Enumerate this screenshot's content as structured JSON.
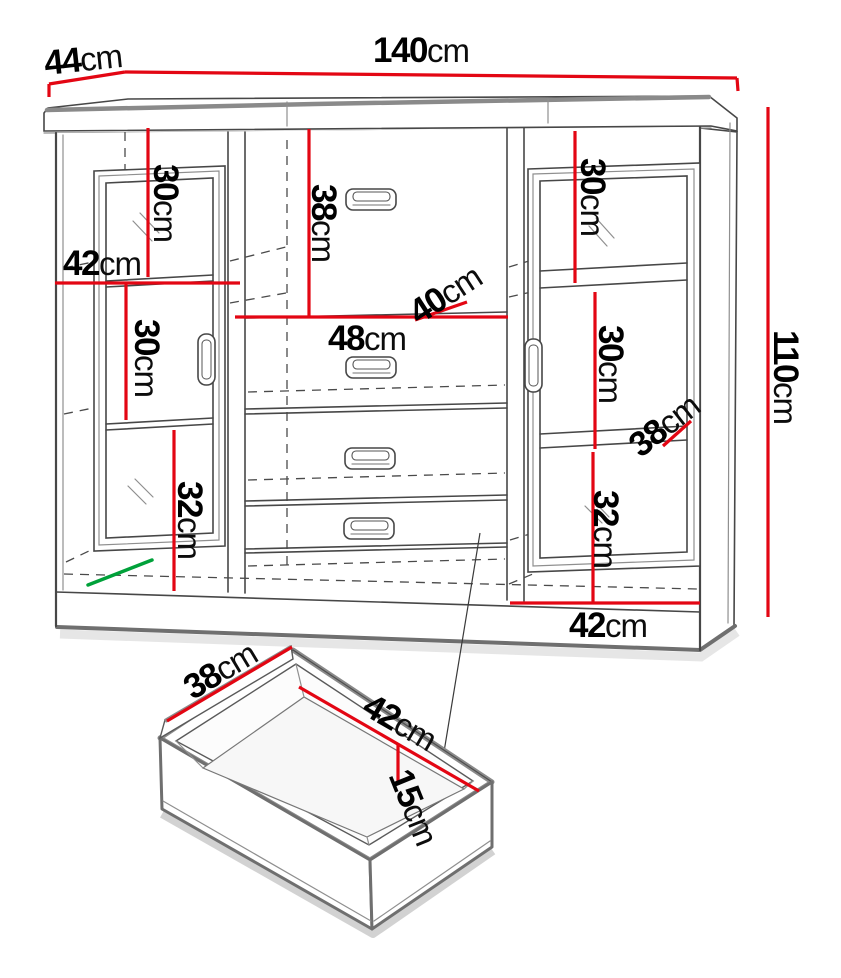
{
  "diagram": {
    "type": "furniture-dimension-diagram",
    "subject": "sideboard with two glass doors, four center drawers and an exploded drawer detail",
    "colors": {
      "dimension_line": "#e30613",
      "highlight_line": "#00a13a",
      "outline": "#474747",
      "soft_edge": "#8a8a8a"
    },
    "labels": {
      "depth_top": {
        "num": "44",
        "unit": "cm"
      },
      "width_top": {
        "num": "140",
        "unit": "cm"
      },
      "height_right": {
        "num": "110",
        "unit": "cm"
      },
      "left_shelf_top": {
        "num": "30",
        "unit": "cm"
      },
      "left_opening_width": {
        "num": "42",
        "unit": "cm"
      },
      "left_shelf_mid": {
        "num": "30",
        "unit": "cm"
      },
      "left_shelf_bottom": {
        "num": "32",
        "unit": "cm"
      },
      "middle_top_drawer_height": {
        "num": "38",
        "unit": "cm"
      },
      "middle_opening_width": {
        "num": "48",
        "unit": "cm"
      },
      "middle_depth": {
        "num": "40",
        "unit": "cm"
      },
      "right_shelf_top": {
        "num": "30",
        "unit": "cm"
      },
      "right_shelf_mid": {
        "num": "30",
        "unit": "cm"
      },
      "right_depth": {
        "num": "38",
        "unit": "cm"
      },
      "right_shelf_bottom": {
        "num": "32",
        "unit": "cm"
      },
      "right_opening_width": {
        "num": "42",
        "unit": "cm"
      },
      "drawer_depth": {
        "num": "38",
        "unit": "cm"
      },
      "drawer_width": {
        "num": "42",
        "unit": "cm"
      },
      "drawer_height": {
        "num": "15",
        "unit": "cm"
      }
    }
  }
}
